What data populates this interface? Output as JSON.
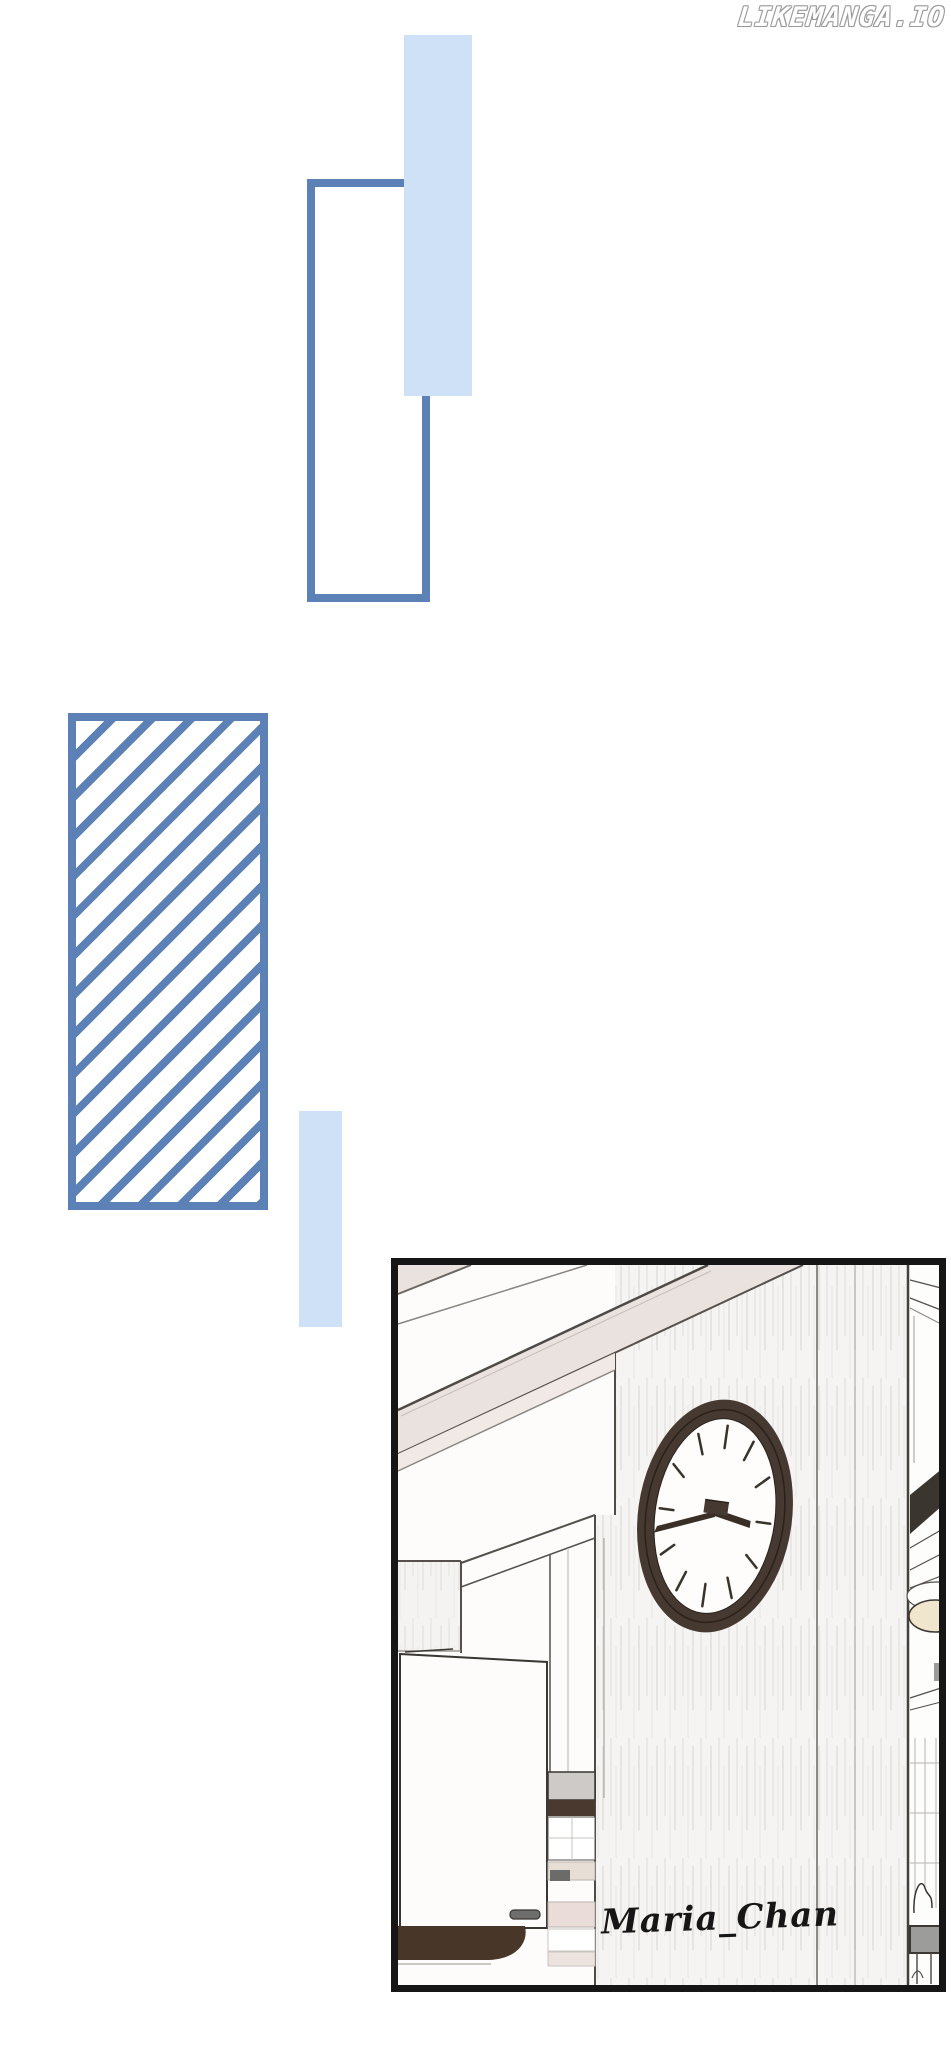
{
  "watermark": {
    "text": "LIKEMANGA.IO"
  },
  "panel": {
    "signature": "Maria_Chan",
    "scene": "kitchen interior with an oval wall clock hanging on a wood-grain pillar, white cabinets at left, shelves with plates and a bowl at right",
    "clock_time_shown": "about 3:42"
  },
  "decorative_shapes": [
    {
      "name": "light-blue-bar-top",
      "color": "#cfe1f6"
    },
    {
      "name": "blue-outlined-rectangle",
      "color": "#5b81b7"
    },
    {
      "name": "diagonal-hatched-rectangle",
      "stroke_color": "#5b81b7",
      "fill": "white"
    },
    {
      "name": "light-blue-bar-middle",
      "color": "#cfe1f6"
    }
  ],
  "colors": {
    "steel_blue": "#5b81b7",
    "light_blue": "#cfe1f6",
    "panel_border": "#161616",
    "clock_frame": "#463931",
    "wood": "#f4f2ef",
    "beige_beam": "#eae2df",
    "dark_brown": "#483728",
    "table_gray": "#9c9c9a",
    "cream_bowl": "#efe6cd"
  }
}
